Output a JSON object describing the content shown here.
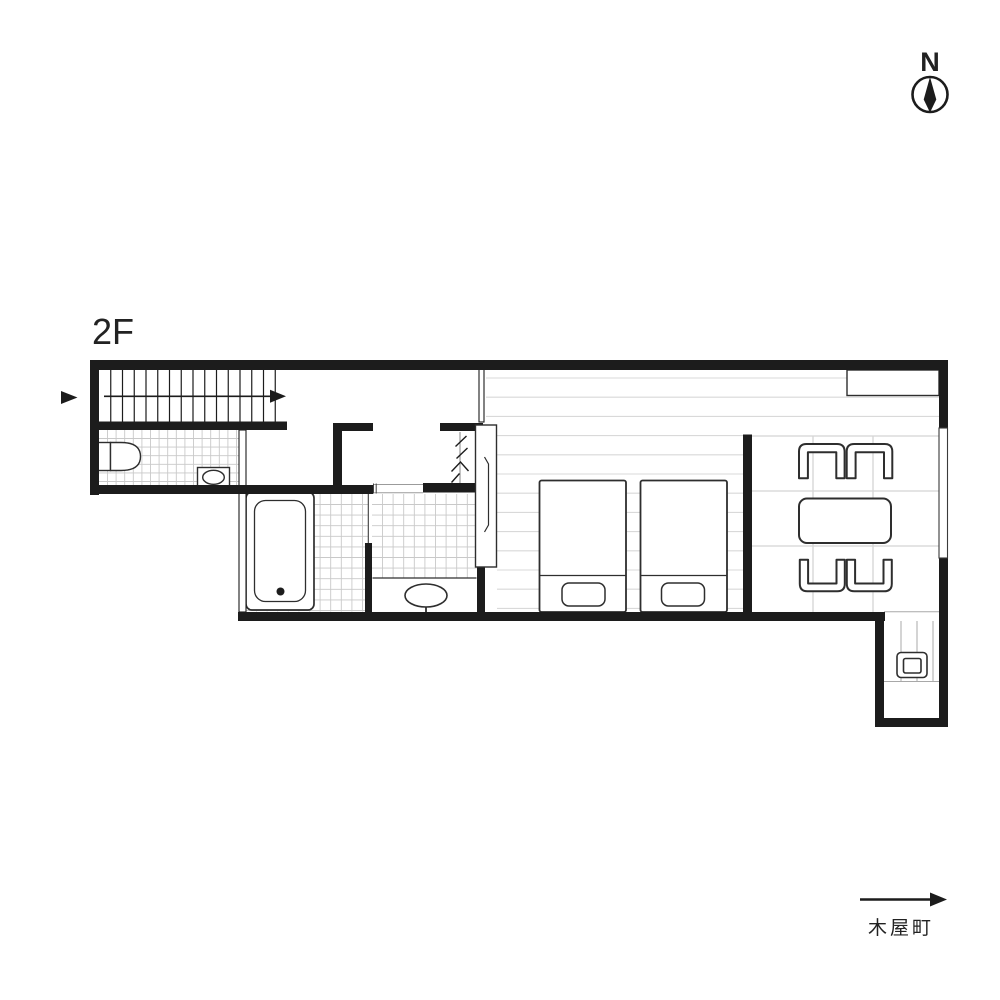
{
  "title": "2F floor plan",
  "labels": {
    "floor": "2F",
    "compass_north": "N",
    "street": "木屋町"
  },
  "colors": {
    "background": "#ffffff",
    "wall": "#1c1c1c",
    "fixture_stroke": "#2e2e2e",
    "tile_line": "#c9c9c9",
    "plank_line": "#d9d9d9",
    "grid_line": "#d4d4d4",
    "extension_line": "#a8a8a8",
    "frame_line": "#9b9b9b",
    "text": "#222222"
  },
  "icons": [
    {
      "name": "compass-icon",
      "meaning": "north direction indicator"
    },
    {
      "name": "entry-arrow-icon",
      "meaning": "entry / approach direction"
    },
    {
      "name": "stairs-direction-arrow-icon",
      "meaning": "direction of stairs"
    },
    {
      "name": "street-arrow-icon",
      "meaning": "street orientation"
    }
  ],
  "rooms": [
    {
      "name": "stairs"
    },
    {
      "name": "toilet-room"
    },
    {
      "name": "hallway"
    },
    {
      "name": "closet"
    },
    {
      "name": "bathroom"
    },
    {
      "name": "powder-room"
    },
    {
      "name": "bedroom"
    },
    {
      "name": "dining-area"
    },
    {
      "name": "rear-extension"
    }
  ],
  "fixtures": [
    "toilet",
    "corner-hand-basin",
    "bathtub",
    "vanity-sink",
    "sliding-panel",
    "folding-door",
    "bed-1",
    "bed-2",
    "dining-table",
    "chair-1",
    "chair-2",
    "chair-3",
    "chair-4",
    "counter",
    "window",
    "rear-fixture"
  ],
  "patterns": {
    "repeats": [
      {
        "target": "stair-treads",
        "axis": "v",
        "start": 110.75,
        "step": 11.75,
        "limit": 280,
        "a1": 370,
        "a2": 421.5,
        "color": "#1c1c1c",
        "width": 1.2
      },
      {
        "target": "floor-tiles-toilet",
        "axis": "v",
        "start": 107.5,
        "step": 8.6,
        "limit": 237.5,
        "a1": 430,
        "a2": 485,
        "color": "#c9c9c9",
        "width": 0.9
      },
      {
        "target": "floor-tiles-toilet",
        "axis": "h",
        "start": 438.5,
        "step": 8.6,
        "limit": 484.5,
        "a1": 99,
        "a2": 238.5,
        "color": "#c9c9c9",
        "width": 0.9
      },
      {
        "target": "floor-tiles-bath",
        "axis": "v",
        "start": 256.5,
        "step": 10.6,
        "limit": 367.5,
        "a1": 494,
        "a2": 611.5,
        "color": "#c9c9c9",
        "width": 0.9
      },
      {
        "target": "floor-tiles-bath",
        "axis": "h",
        "start": 504.5,
        "step": 10.6,
        "limit": 611,
        "a1": 246,
        "a2": 368,
        "color": "#c9c9c9",
        "width": 0.9
      },
      {
        "target": "floor-tiles-sink",
        "axis": "v",
        "start": 382.5,
        "step": 10.6,
        "limit": 476.5,
        "a1": 494,
        "a2": 578,
        "color": "#c9c9c9",
        "width": 0.9
      },
      {
        "target": "floor-tiles-sink",
        "axis": "h",
        "start": 504.5,
        "step": 10.6,
        "limit": 577.5,
        "a1": 372,
        "a2": 477,
        "color": "#c9c9c9",
        "width": 0.9
      },
      {
        "target": "floor-planks-a",
        "axis": "h",
        "start": 378,
        "step": 19.2,
        "limit": 433,
        "a1": 486,
        "a2": 939,
        "color": "#d9d9d9",
        "width": 1.1
      },
      {
        "target": "floor-planks-b",
        "axis": "h",
        "start": 435.6,
        "step": 19.2,
        "limit": 611,
        "a1": 497,
        "a2": 743,
        "color": "#d9d9d9",
        "width": 1.1
      },
      {
        "target": "floor-extension",
        "axis": "v",
        "start": 901,
        "step": 16,
        "limit": 934,
        "a1": 621,
        "a2": 681,
        "color": "#a8a8a8",
        "width": 1.0
      }
    ],
    "segments": [
      {
        "target": "floor-grid-dining",
        "color": "#d4d4d4",
        "width": 1.3,
        "lines": [
          [
            752,
            436,
            939,
            436
          ],
          [
            752,
            491,
            939,
            491
          ],
          [
            752,
            546,
            939,
            546
          ],
          [
            813,
            436,
            813,
            612
          ],
          [
            873,
            436,
            873,
            612
          ]
        ]
      },
      {
        "target": "floor-extension",
        "color": "#a8a8a8",
        "width": 1.0,
        "lines": [
          [
            884,
            681.5,
            939,
            681.5
          ],
          [
            884,
            611.7,
            939,
            611.7
          ]
        ]
      }
    ]
  }
}
